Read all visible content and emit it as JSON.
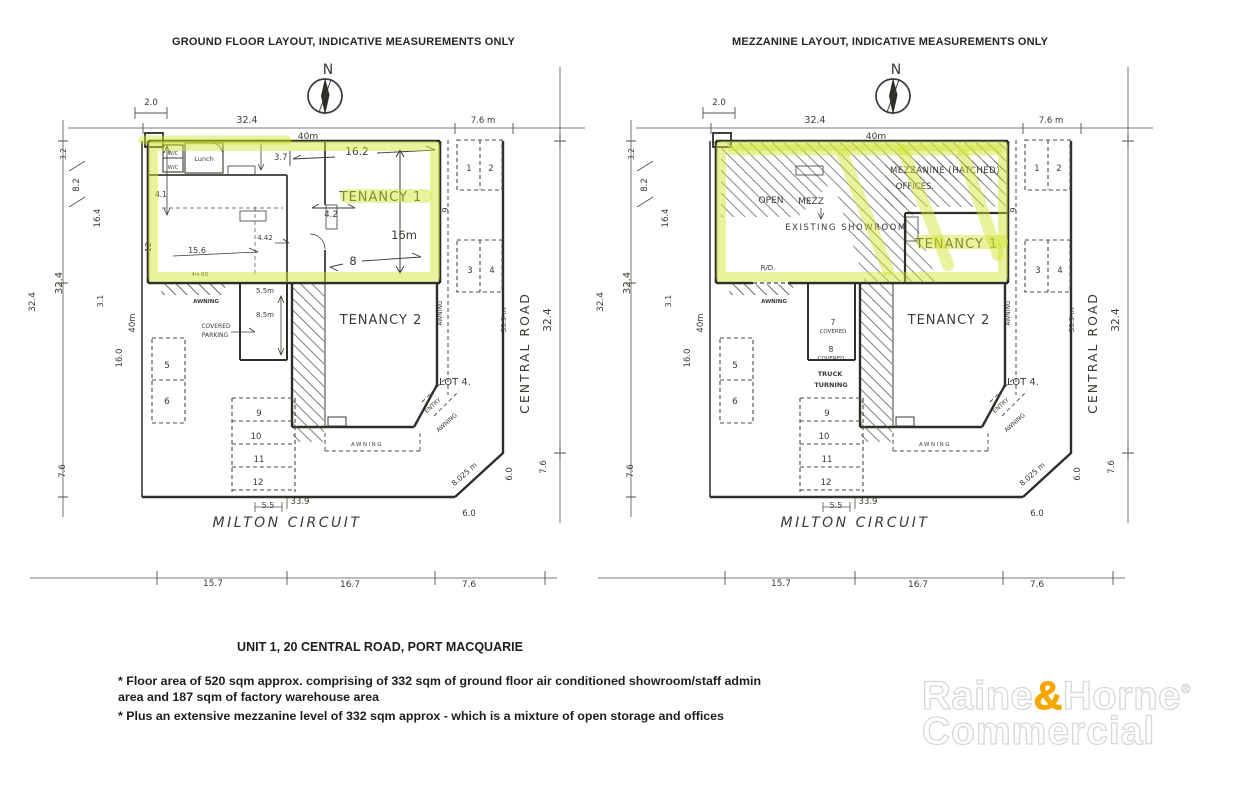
{
  "colors": {
    "highlight": "#D7E542",
    "logo_accent": "#F7A600",
    "ink": "#3B3A33"
  },
  "site": {
    "north": "N",
    "top": {
      "d20": "2.0",
      "d324": "32.4",
      "d40m": "40m",
      "d76m": "7.6 m"
    },
    "left": {
      "d32": "3.2",
      "d82": "8.2",
      "d164": "16.4",
      "d324": "32.4",
      "d31": "3.1",
      "d40m": "40m",
      "d160": "16.0",
      "d76": "7.6",
      "edge324": "32.4"
    },
    "right": {
      "d339m": "33.9 m",
      "road": "CENTRAL ROAD",
      "d324": "32.4",
      "d9": "9",
      "awning": "AWNING",
      "d60a": "6.0",
      "d60b": "6.0",
      "d76": "7.6",
      "d8025": "8.025 m"
    },
    "bottom": {
      "d55": "5.5",
      "d339": "33.9",
      "road": "MILTON CIRCUIT",
      "d157": "15.7",
      "d167": "16.7",
      "d76": "7.6"
    },
    "lot": "LOT 4.",
    "parking": {
      "p1": "1",
      "p2": "2",
      "p3": "3",
      "p4": "4",
      "p5": "5",
      "p6": "6",
      "p9": "9",
      "p10": "10",
      "p11": "11",
      "p12": "12"
    },
    "corner": {
      "entry": "ENTRY",
      "awning": "AWNING"
    },
    "awning_bottom": "AWNING",
    "awning_left": "AWNING"
  },
  "ground": {
    "heading": "GROUND FLOOR LAYOUT, INDICATIVE MEASUREMENTS ONLY",
    "rooms": {
      "wc1": "W/C",
      "wc2": "W/C",
      "lunch": "Lunch"
    },
    "dims": {
      "d37": "3.7",
      "d162": "16.2",
      "d41": "4.1",
      "d42": "4.2",
      "d12": "12",
      "d156": "15.6",
      "d442": "4.42",
      "d8": "8",
      "d16m": "16m",
      "d55m": "5.5m",
      "d85m": "8.5m"
    },
    "tenancy1": "TENANCY 1",
    "tenancy2": "TENANCY 2",
    "covered1": "COVERED",
    "covered2": "PARKING",
    "rd": "4m RD"
  },
  "mezzanine": {
    "heading": "MEZZANINE LAYOUT, INDICATIVE MEASUREMENTS ONLY",
    "open1": "OPEN",
    "open2": "MEZZ",
    "mezz_note": "MEZZANINE (HATCHED)",
    "offices": "OFFICES.",
    "showroom": "EXISTING  SHOWROOM",
    "tenancy1": "TENANCY 1",
    "tenancy2": "TENANCY 2",
    "rd": "R/D.",
    "c7_num": "7",
    "c7_label": "COVERED",
    "c8_num": "8",
    "c8_label": "COVERED",
    "truck1": "TRUCK",
    "truck2": "TURNING"
  },
  "footer": {
    "title": "UNIT 1, 20 CENTRAL ROAD, PORT MACQUARIE",
    "bullets": [
      "* Floor area of 520 sqm approx. comprising of 332 sqm of ground floor air conditioned showroom/staff admin area and 187 sqm of factory warehouse area",
      "* Plus an extensive mezzanine level of 332 sqm approx - which is a mixture of open storage and offices"
    ]
  },
  "logo": {
    "word1": "Raine",
    "amp": "&",
    "word2": "Horne",
    "reg": "®",
    "line2": "Commercial"
  }
}
